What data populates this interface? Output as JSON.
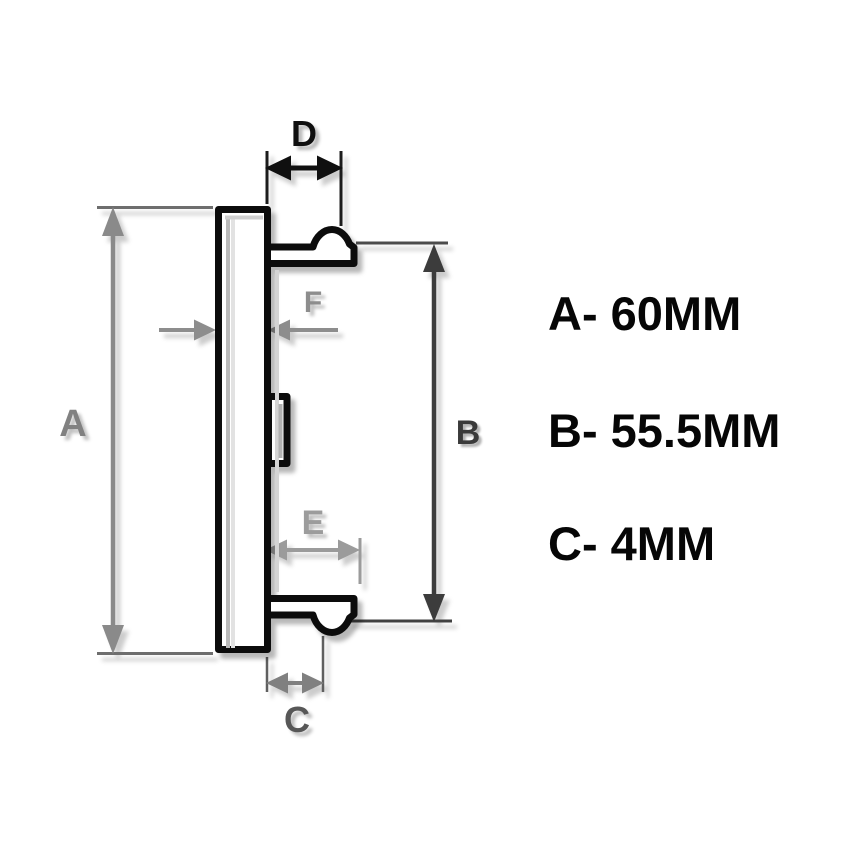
{
  "diagram": {
    "labels": {
      "a": "A",
      "b": "B",
      "c": "C",
      "d": "D",
      "e": "E",
      "f": "F"
    }
  },
  "specs": {
    "items": [
      {
        "id": "A",
        "text": "A- 60MM"
      },
      {
        "id": "B",
        "text": "B- 55.5MM"
      },
      {
        "id": "C",
        "text": "C- 4MM"
      }
    ]
  },
  "colors": {
    "background": "#ffffff",
    "object_outline": "#0c0c0c",
    "gray_dimension": "#8a8a8a",
    "dark_dimension": "#3c3c3c",
    "spec_text": "#060606"
  }
}
